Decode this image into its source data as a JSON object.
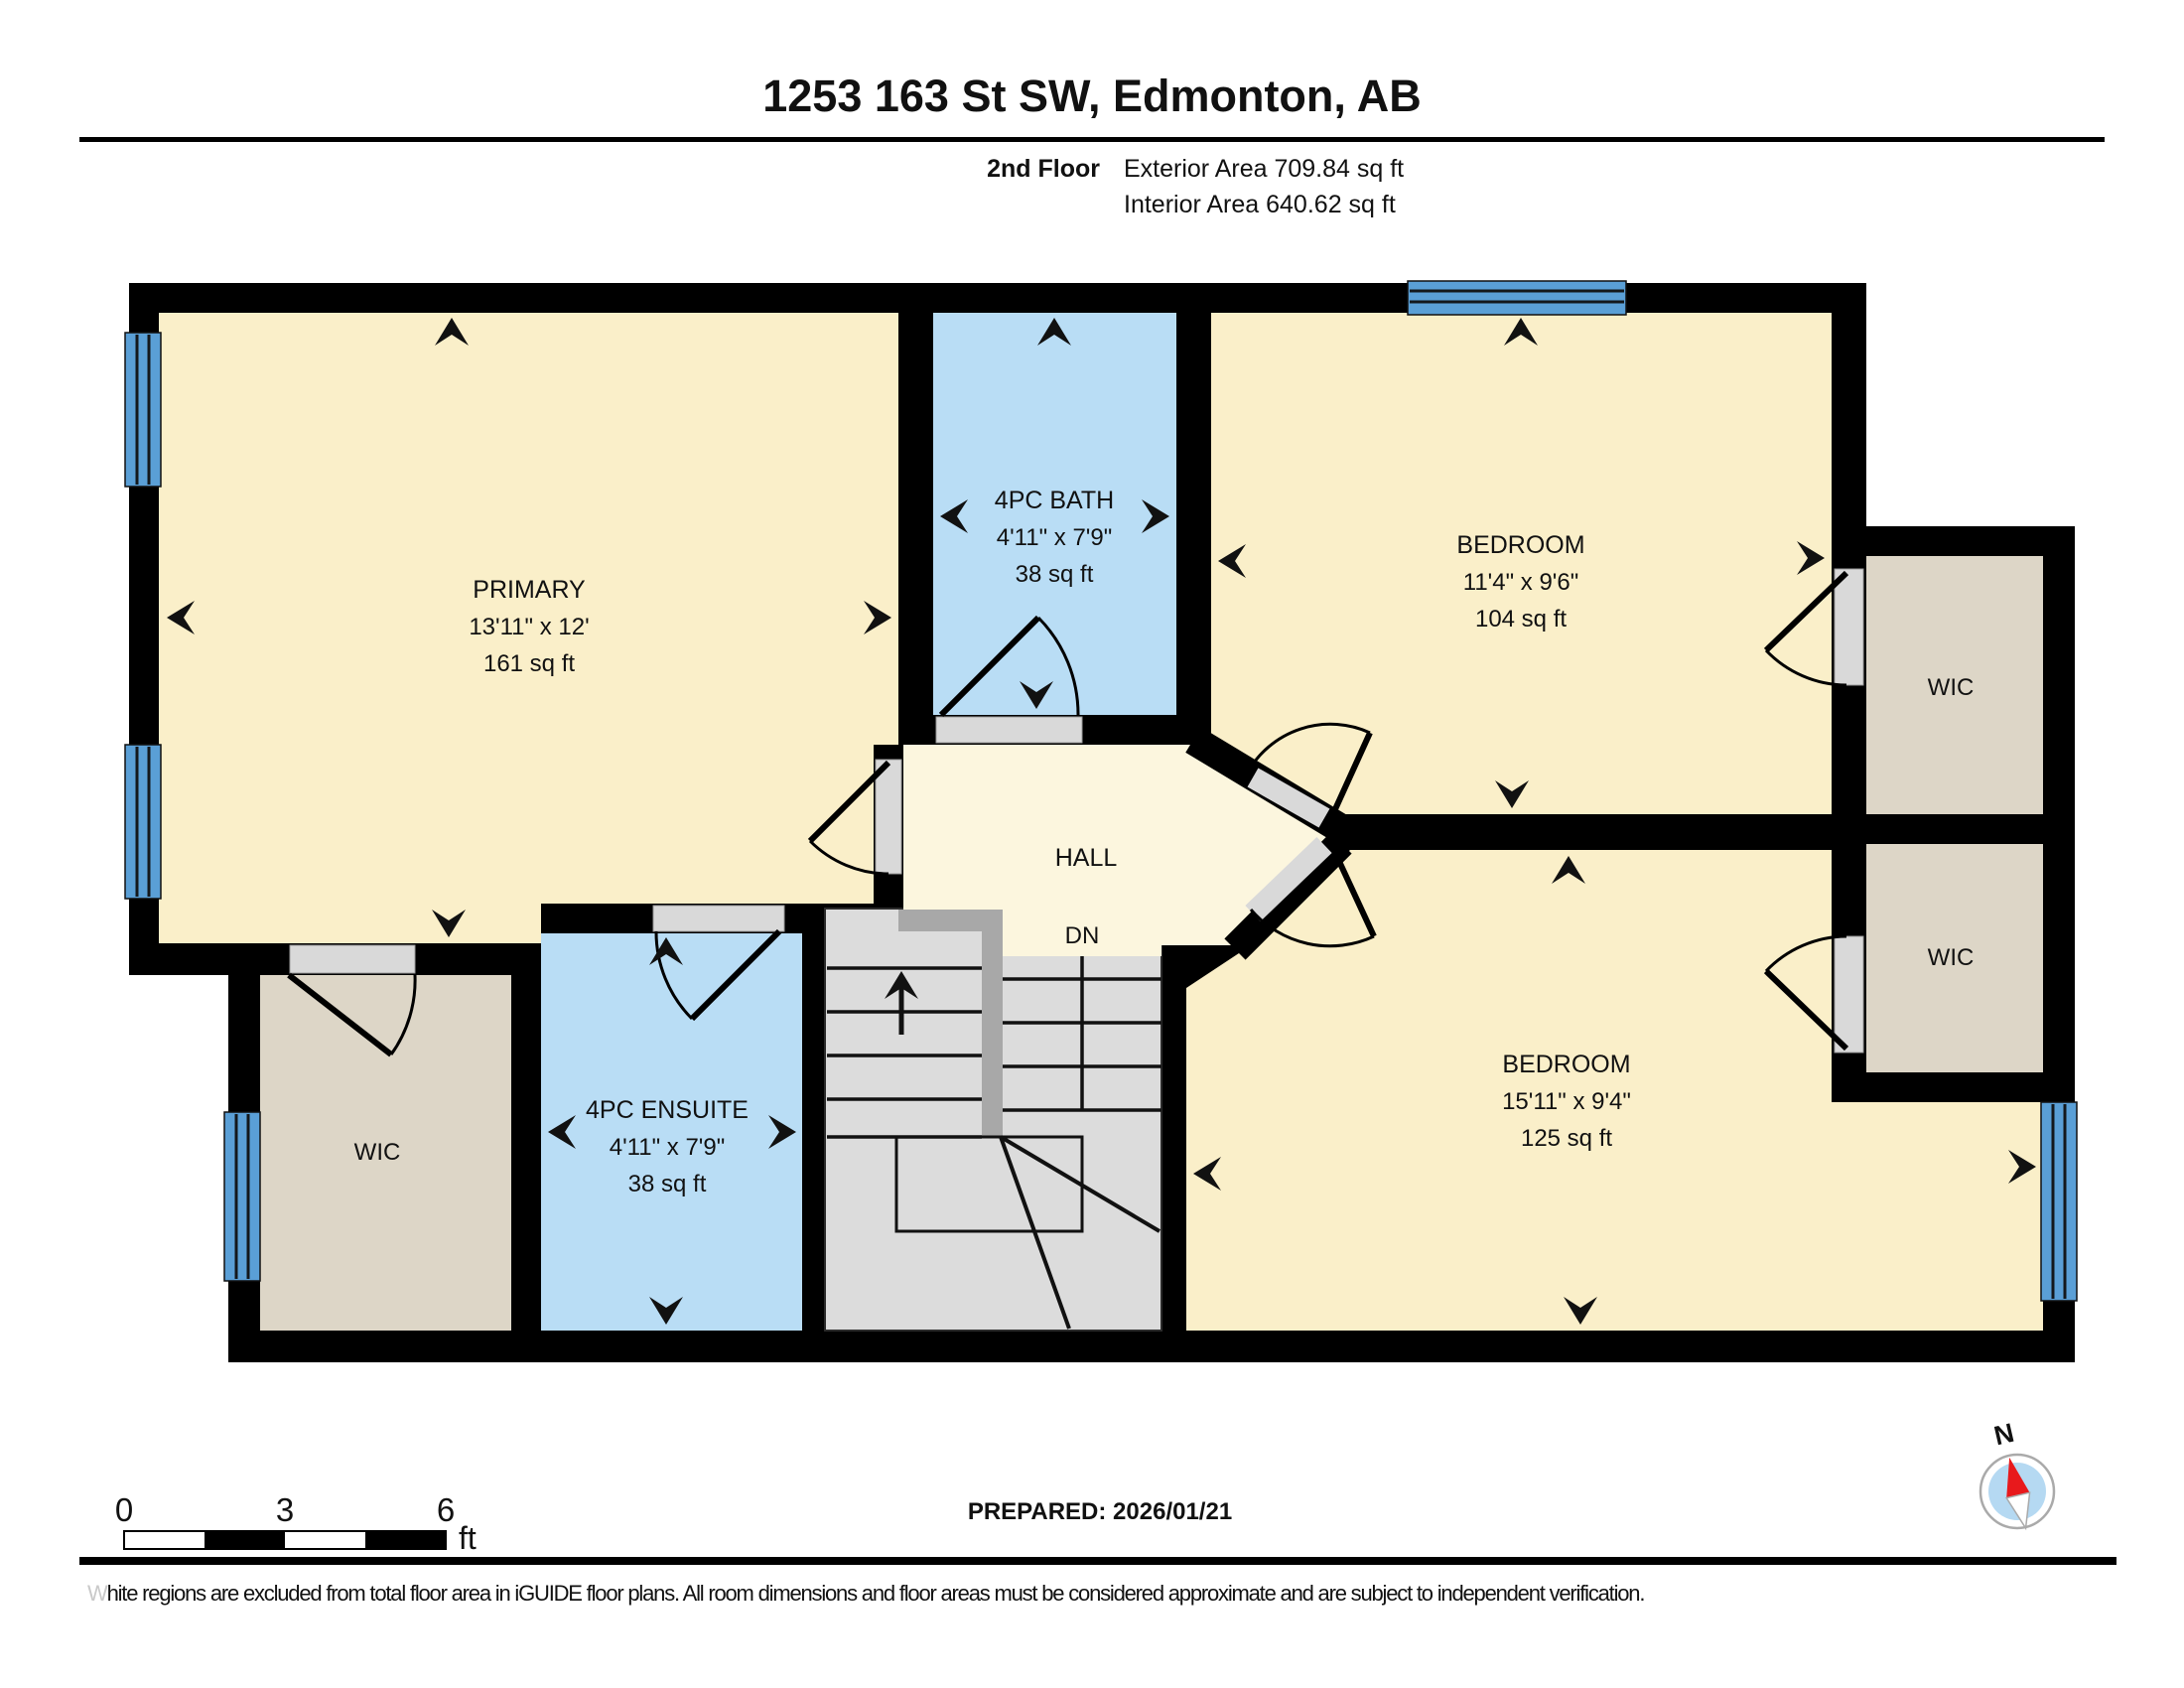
{
  "header": {
    "title": "1253 163 St SW, Edmonton, AB",
    "floor_label": "2nd Floor",
    "exterior_area": "Exterior Area 709.84 sq ft",
    "interior_area": "Interior Area 640.62 sq ft"
  },
  "rooms": {
    "primary": {
      "name": "PRIMARY",
      "dims": "13'11\" x 12'",
      "area": "161 sq ft"
    },
    "bath": {
      "name": "4PC BATH",
      "dims": "4'11\" x 7'9\"",
      "area": "38 sq ft"
    },
    "bedroom_top": {
      "name": "BEDROOM",
      "dims": "11'4\" x 9'6\"",
      "area": "104 sq ft"
    },
    "wic_top_right": {
      "name": "WIC"
    },
    "wic_bottom_right": {
      "name": "WIC"
    },
    "hall": {
      "name": "HALL",
      "dn": "DN"
    },
    "ensuite": {
      "name": "4PC ENSUITE",
      "dims": "4'11\" x 7'9\"",
      "area": "38 sq ft"
    },
    "wic_left": {
      "name": "WIC"
    },
    "bedroom_bottom": {
      "name": "BEDROOM",
      "dims": "15'11\" x 9'4\"",
      "area": "125 sq ft"
    }
  },
  "scale_bar": {
    "tick_0": "0",
    "tick_3": "3",
    "tick_6": "6",
    "unit": "ft"
  },
  "footer": {
    "prepared": "PREPARED: 2026/01/21",
    "compass_label": "N",
    "disclaimer_lead": "W",
    "disclaimer_rest": "hite regions are excluded from total floor area in iGUIDE floor plans. All room dimensions and floor areas must be considered approximate and are subject to independent verification."
  },
  "colors": {
    "wall": "#000000",
    "room_cream": "#FAEFC9",
    "hall_cream": "#FCF6DE",
    "wet_room_blue": "#B9DDF5",
    "closet_taupe": "#DDD6C7",
    "stairs_grey": "#DCDCDC",
    "stair_rail_grey": "#A8A8A8",
    "window_blue": "#5A9FD6",
    "door_grey": "#D9D9D9",
    "compass_red": "#E8191C",
    "text": "#111111"
  }
}
